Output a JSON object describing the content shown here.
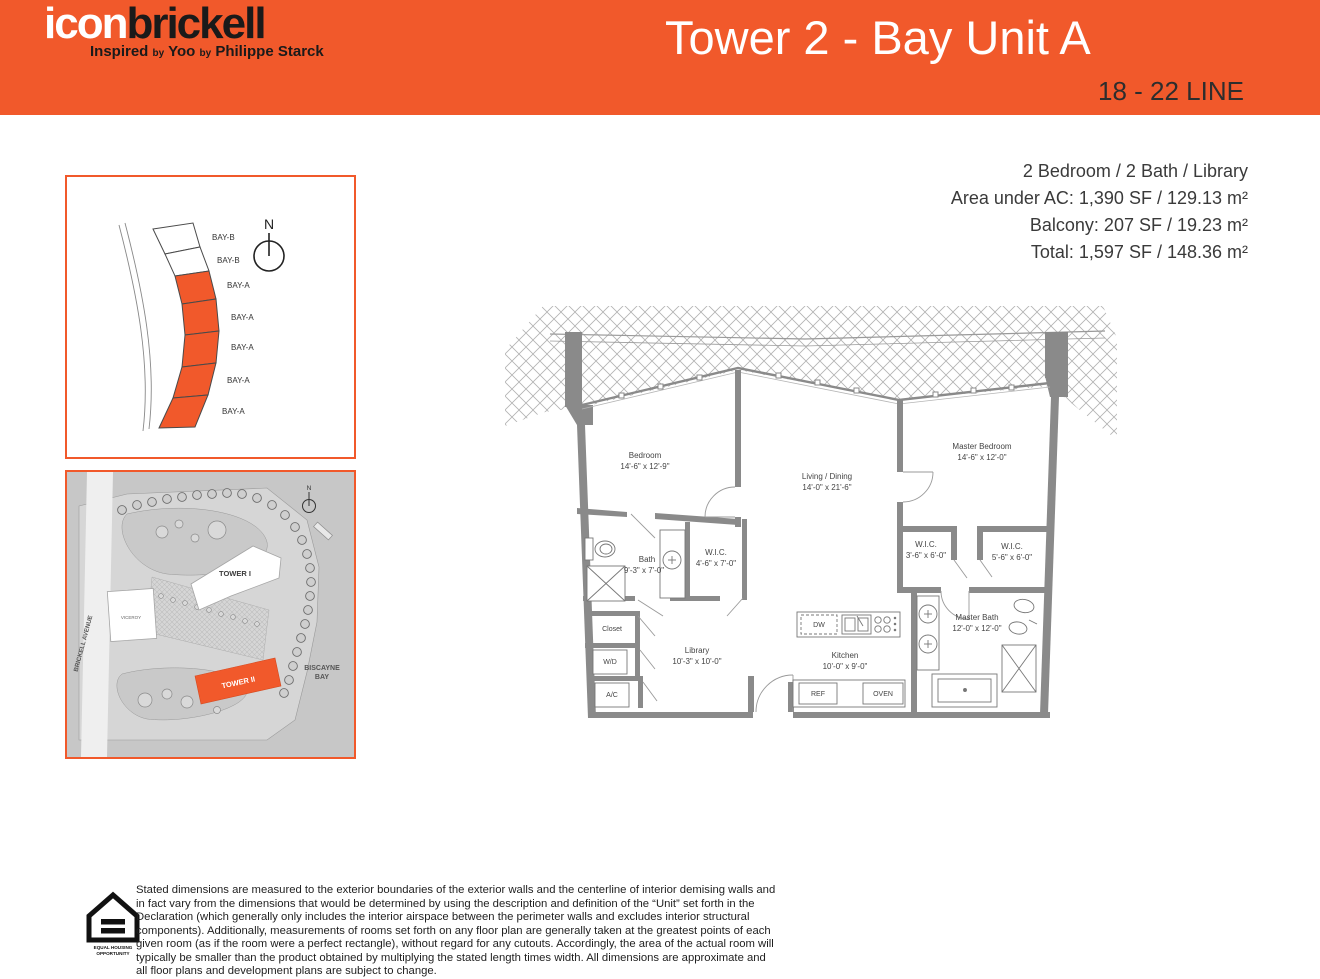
{
  "colors": {
    "accent": "#F1592B",
    "wall_gray": "#8a8a8a",
    "text_dark": "#2d2d2d"
  },
  "header": {
    "logo_part1": "icon",
    "logo_part2": "brickell",
    "tagline_word1": "Inspired",
    "tagline_by1": "by",
    "tagline_word2": "Yoo",
    "tagline_by2": "by",
    "tagline_word3": "Philippe Starck",
    "title": "Tower 2 - Bay Unit A",
    "line_range": "18 - 22 LINE"
  },
  "unit_info": {
    "line1": "2 Bedroom / 2 Bath / Library",
    "line2": "Area under AC: 1,390 SF / 129.13 m²",
    "line3": "Balcony: 207 SF / 19.23 m²",
    "line4": "Total: 1,597 SF / 148.36 m²"
  },
  "key_plan": {
    "north_label": "N",
    "bays": [
      {
        "label": "BAY-B"
      },
      {
        "label": "BAY-B"
      },
      {
        "label": "BAY-A"
      },
      {
        "label": "BAY-A"
      },
      {
        "label": "BAY-A"
      },
      {
        "label": "BAY-A"
      },
      {
        "label": "BAY-A"
      }
    ]
  },
  "site_plan": {
    "north_label": "N",
    "street_label": "BRICKELL AVENUE",
    "water_label_line1": "BISCAYNE",
    "water_label_line2": "BAY",
    "viceroy_label": "VICEROY",
    "tower1_label": "TOWER I",
    "tower2_label": "TOWER II"
  },
  "floor_plan": {
    "rooms": [
      {
        "name": "Bedroom",
        "dims": "14'-6\" x 12'-9\""
      },
      {
        "name": "Living / Dining",
        "dims": "14'-0\" x 21'-6\""
      },
      {
        "name": "Master Bedroom",
        "dims": "14'-6\" x 12'-0\""
      },
      {
        "name": "Bath",
        "dims": "9'-3\" x 7'-0\""
      },
      {
        "name": "W.I.C.",
        "dims": "4'-6\" x 7'-0\""
      },
      {
        "name": "Library",
        "dims": "10'-3\" x 10'-0\""
      },
      {
        "name": "Kitchen",
        "dims": "10'-0\" x 9'-0\""
      },
      {
        "name": "W.I.C.",
        "dims": "3'-6\" x 6'-0\""
      },
      {
        "name": "W.I.C.",
        "dims": "5'-6\" x 6'-0\""
      },
      {
        "name": "Master Bath",
        "dims": "12'-0\" x 12'-0\""
      }
    ],
    "closet_label": "Closet",
    "wd_label": "W/D",
    "ac_label": "A/C",
    "dw_label": "DW",
    "ref_label": "REF",
    "oven_label": "OVEN"
  },
  "disclaimer": {
    "eho_line1": "EQUAL HOUSING",
    "eho_line2": "OPPORTUNITY",
    "text": "Stated dimensions are measured to the exterior boundaries of the exterior walls and the centerline of interior demising walls and in fact vary from the dimensions that would be determined by using the description and definition of the “Unit” set forth in the Declaration (which generally only includes the interior airspace between the perimeter walls and excludes interior structural components). Additionally, measurements of rooms set forth on any floor plan are generally taken at the greatest points of each given room (as if the room were a perfect rectangle), without regard for any cutouts. Accordingly, the area of the actual room will typically be smaller than the product obtained by multiplying the stated length times width. All dimensions are approximate and all floor plans and development plans are subject to change."
  }
}
